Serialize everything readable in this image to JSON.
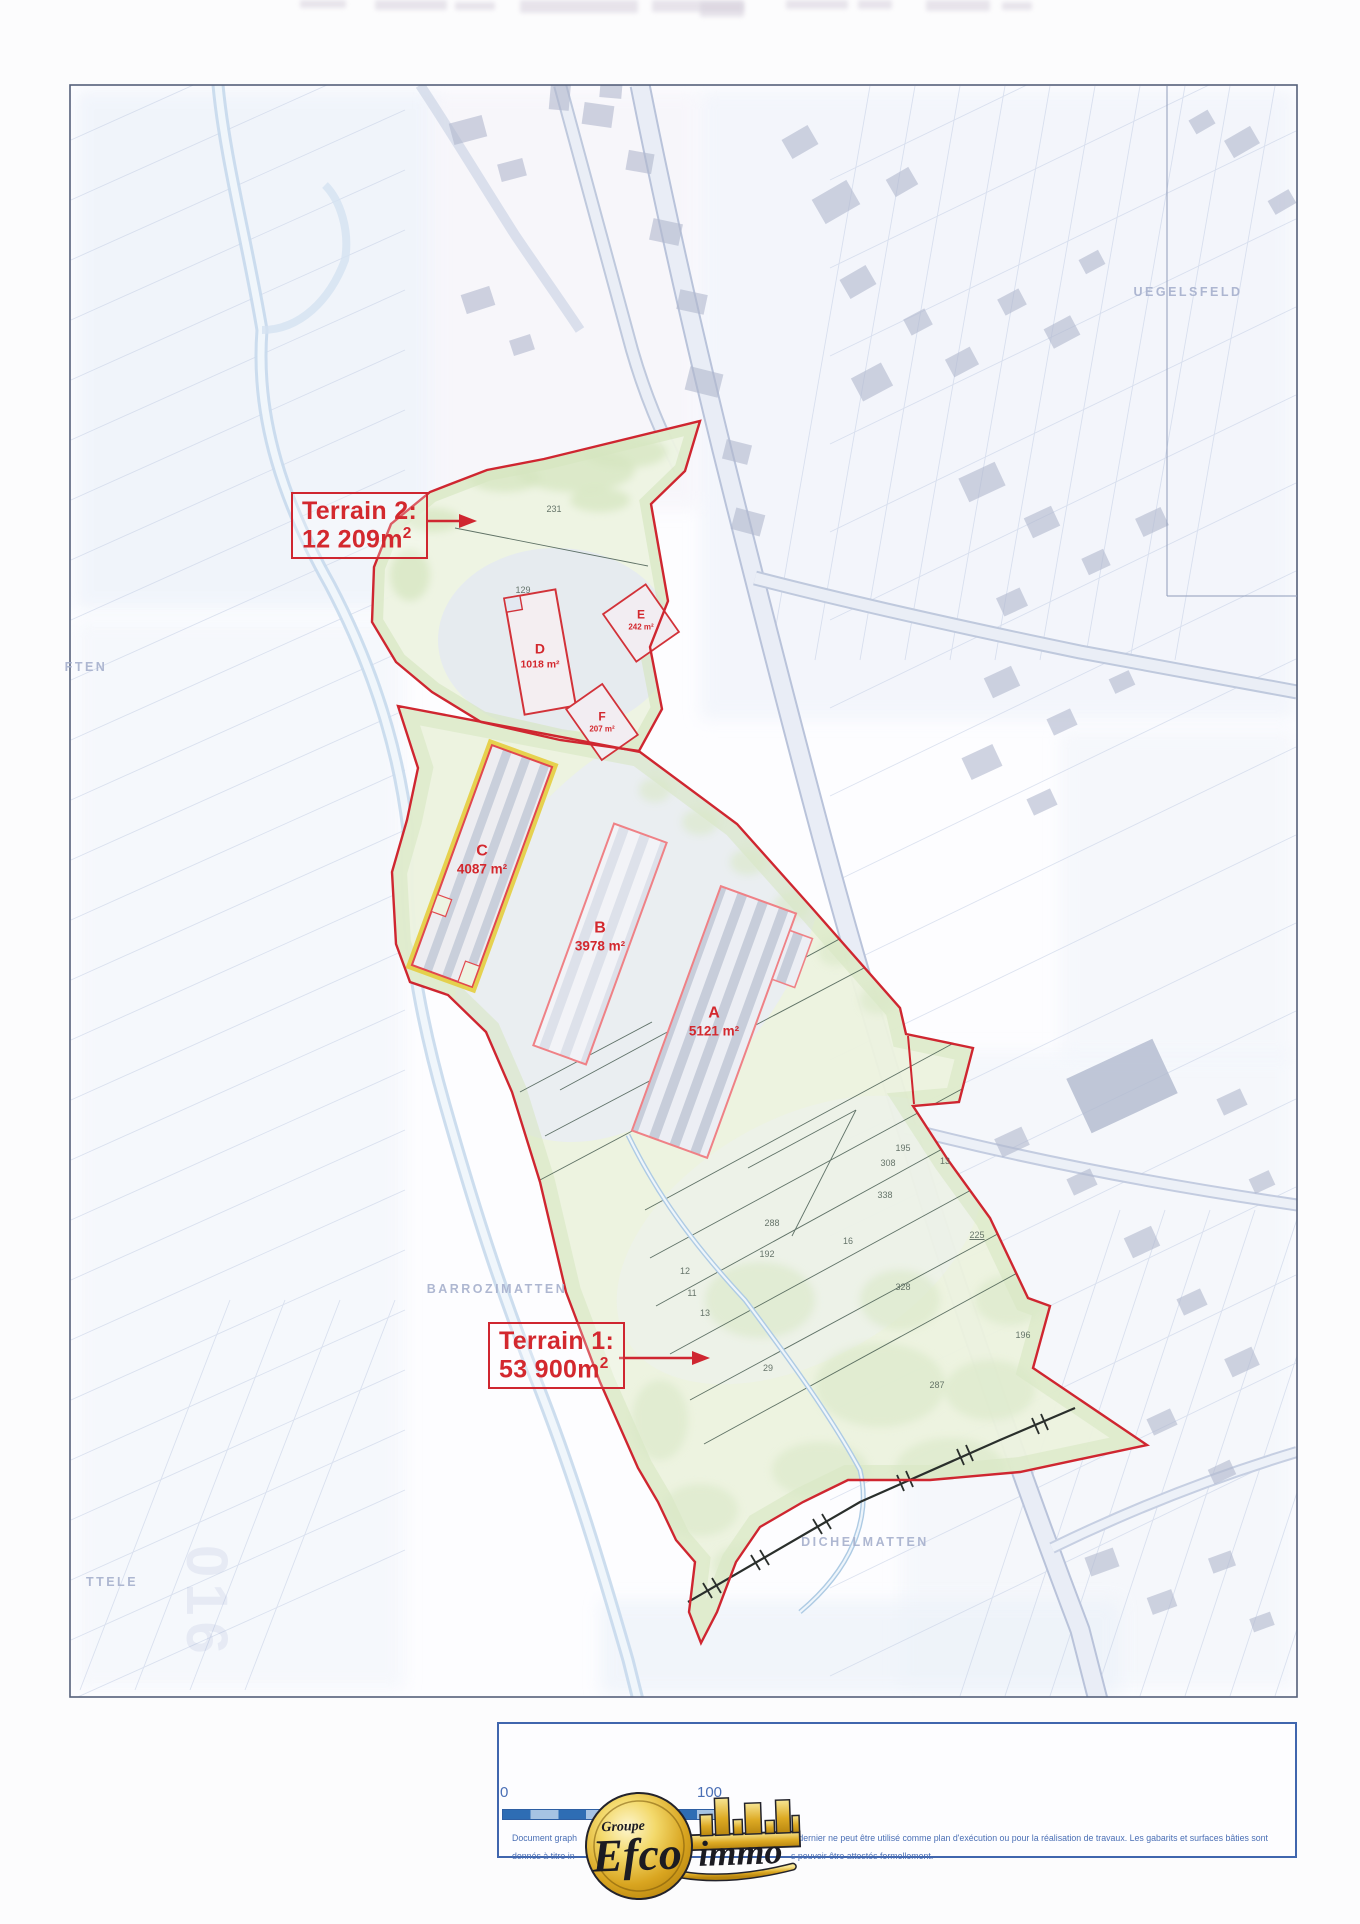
{
  "colors": {
    "red": "#d3282e",
    "terrain_outline": "#cf2630",
    "pink_outline": "#ef8186",
    "yellow_highlight": "#e4cd3e",
    "map_text_blue": "#a6b0cd",
    "footer_blue": "#4a6fb5",
    "scale_blue": "#2e6db4",
    "logo_gold": "#d9a520"
  },
  "terrain2_label": {
    "title": "Terrain 2:",
    "area": "12 209m",
    "area_sup": "2"
  },
  "terrain1_label": {
    "title": "Terrain 1:",
    "area": "53 900m",
    "area_sup": "2"
  },
  "buildings": {
    "a": {
      "letter": "A",
      "area": "5121 m²"
    },
    "b": {
      "letter": "B",
      "area": "3978 m²"
    },
    "c": {
      "letter": "C",
      "area": "4087 m²"
    },
    "d": {
      "letter": "D",
      "area": "1018 m²"
    },
    "e": {
      "letter": "E",
      "area": "242 m²"
    },
    "f": {
      "letter": "F",
      "area": "207 m²"
    }
  },
  "place_names": [
    {
      "label": "UEGELSFELD",
      "x": 1188,
      "y": 292
    },
    {
      "label": "BARROZIMATTEN",
      "x": 497,
      "y": 1289
    },
    {
      "label": "DICHELMATTEN",
      "x": 865,
      "y": 1542
    },
    {
      "label": "FTEN",
      "x": 86,
      "y": 667
    },
    {
      "label": "TTELE",
      "x": 112,
      "y": 1582
    }
  ],
  "watermark": {
    "label": "016"
  },
  "parcel_numbers": [
    {
      "x": 903,
      "y": 1148,
      "label": "195"
    },
    {
      "x": 888,
      "y": 1163,
      "label": "308"
    },
    {
      "x": 945,
      "y": 1161,
      "label": "13"
    },
    {
      "x": 885,
      "y": 1195,
      "label": "338"
    },
    {
      "x": 772,
      "y": 1223,
      "label": "288"
    },
    {
      "x": 848,
      "y": 1241,
      "label": "16"
    },
    {
      "x": 767,
      "y": 1254,
      "label": "192"
    },
    {
      "x": 977,
      "y": 1235,
      "label": "225",
      "u": 1
    },
    {
      "x": 903,
      "y": 1287,
      "label": "328"
    },
    {
      "x": 685,
      "y": 1271,
      "label": "12"
    },
    {
      "x": 692,
      "y": 1293,
      "label": "11"
    },
    {
      "x": 705,
      "y": 1313,
      "label": "13"
    },
    {
      "x": 768,
      "y": 1368,
      "label": "29"
    },
    {
      "x": 937,
      "y": 1385,
      "label": "287"
    },
    {
      "x": 1023,
      "y": 1335,
      "label": "196"
    },
    {
      "x": 523,
      "y": 590,
      "label": "129"
    },
    {
      "x": 554,
      "y": 509,
      "label": "231"
    }
  ],
  "scale_bar": {
    "start": "0",
    "end": "100"
  },
  "footer": {
    "line1_left": "Document graph",
    "line1_right": "e dernier ne peut être utilisé comme plan d'exécution ou pour la réalisation de travaux. Les gabarits et surfaces bâties sont",
    "line2_left": "donnés à titre in",
    "line2_right": "s pouvoir être attestés formellement."
  },
  "logo": {
    "groupe": "Groupe",
    "efco": "Efco",
    "immo": "immo"
  }
}
